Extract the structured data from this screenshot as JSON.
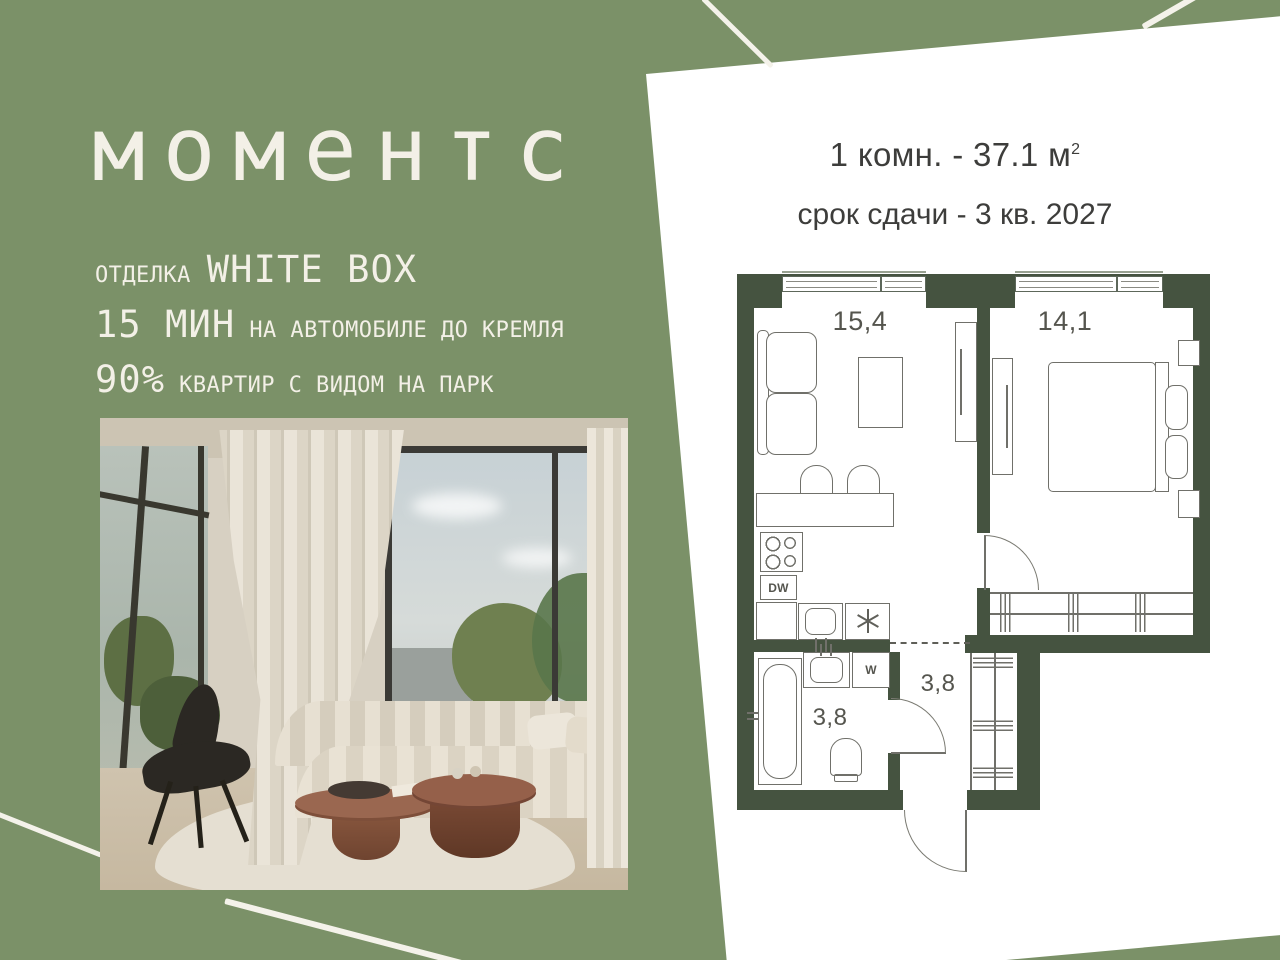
{
  "brand": {
    "logo": "моментс"
  },
  "usp": {
    "finish_label": "ОТДЕЛКА",
    "finish_value": "WHITE BOX",
    "drive_value": "15 МИН",
    "drive_text": "НА АВТОМОБИЛЕ ДО КРЕМЛЯ",
    "park_value": "90%",
    "park_text": "КВАРТИР С ВИДОМ НА ПАРК"
  },
  "offer": {
    "rooms_area": "1 комн. - 37.1 м",
    "area_sup": "2",
    "deadline": "срок сдачи - 3 кв. 2027"
  },
  "floorplan": {
    "rooms": [
      {
        "id": "living-kitchen",
        "area": "15,4"
      },
      {
        "id": "bedroom",
        "area": "14,1"
      },
      {
        "id": "bathroom",
        "area": "3,8"
      },
      {
        "id": "hallway",
        "area": "3,8"
      }
    ],
    "appliances": {
      "dishwasher": "DW",
      "washer": "W"
    }
  },
  "colors": {
    "background_green": "#7b9168",
    "wall_green": "#455340",
    "panel_white": "#ffffff",
    "text_cream": "#f3f0e7",
    "text_dark": "#3d3d3b"
  }
}
